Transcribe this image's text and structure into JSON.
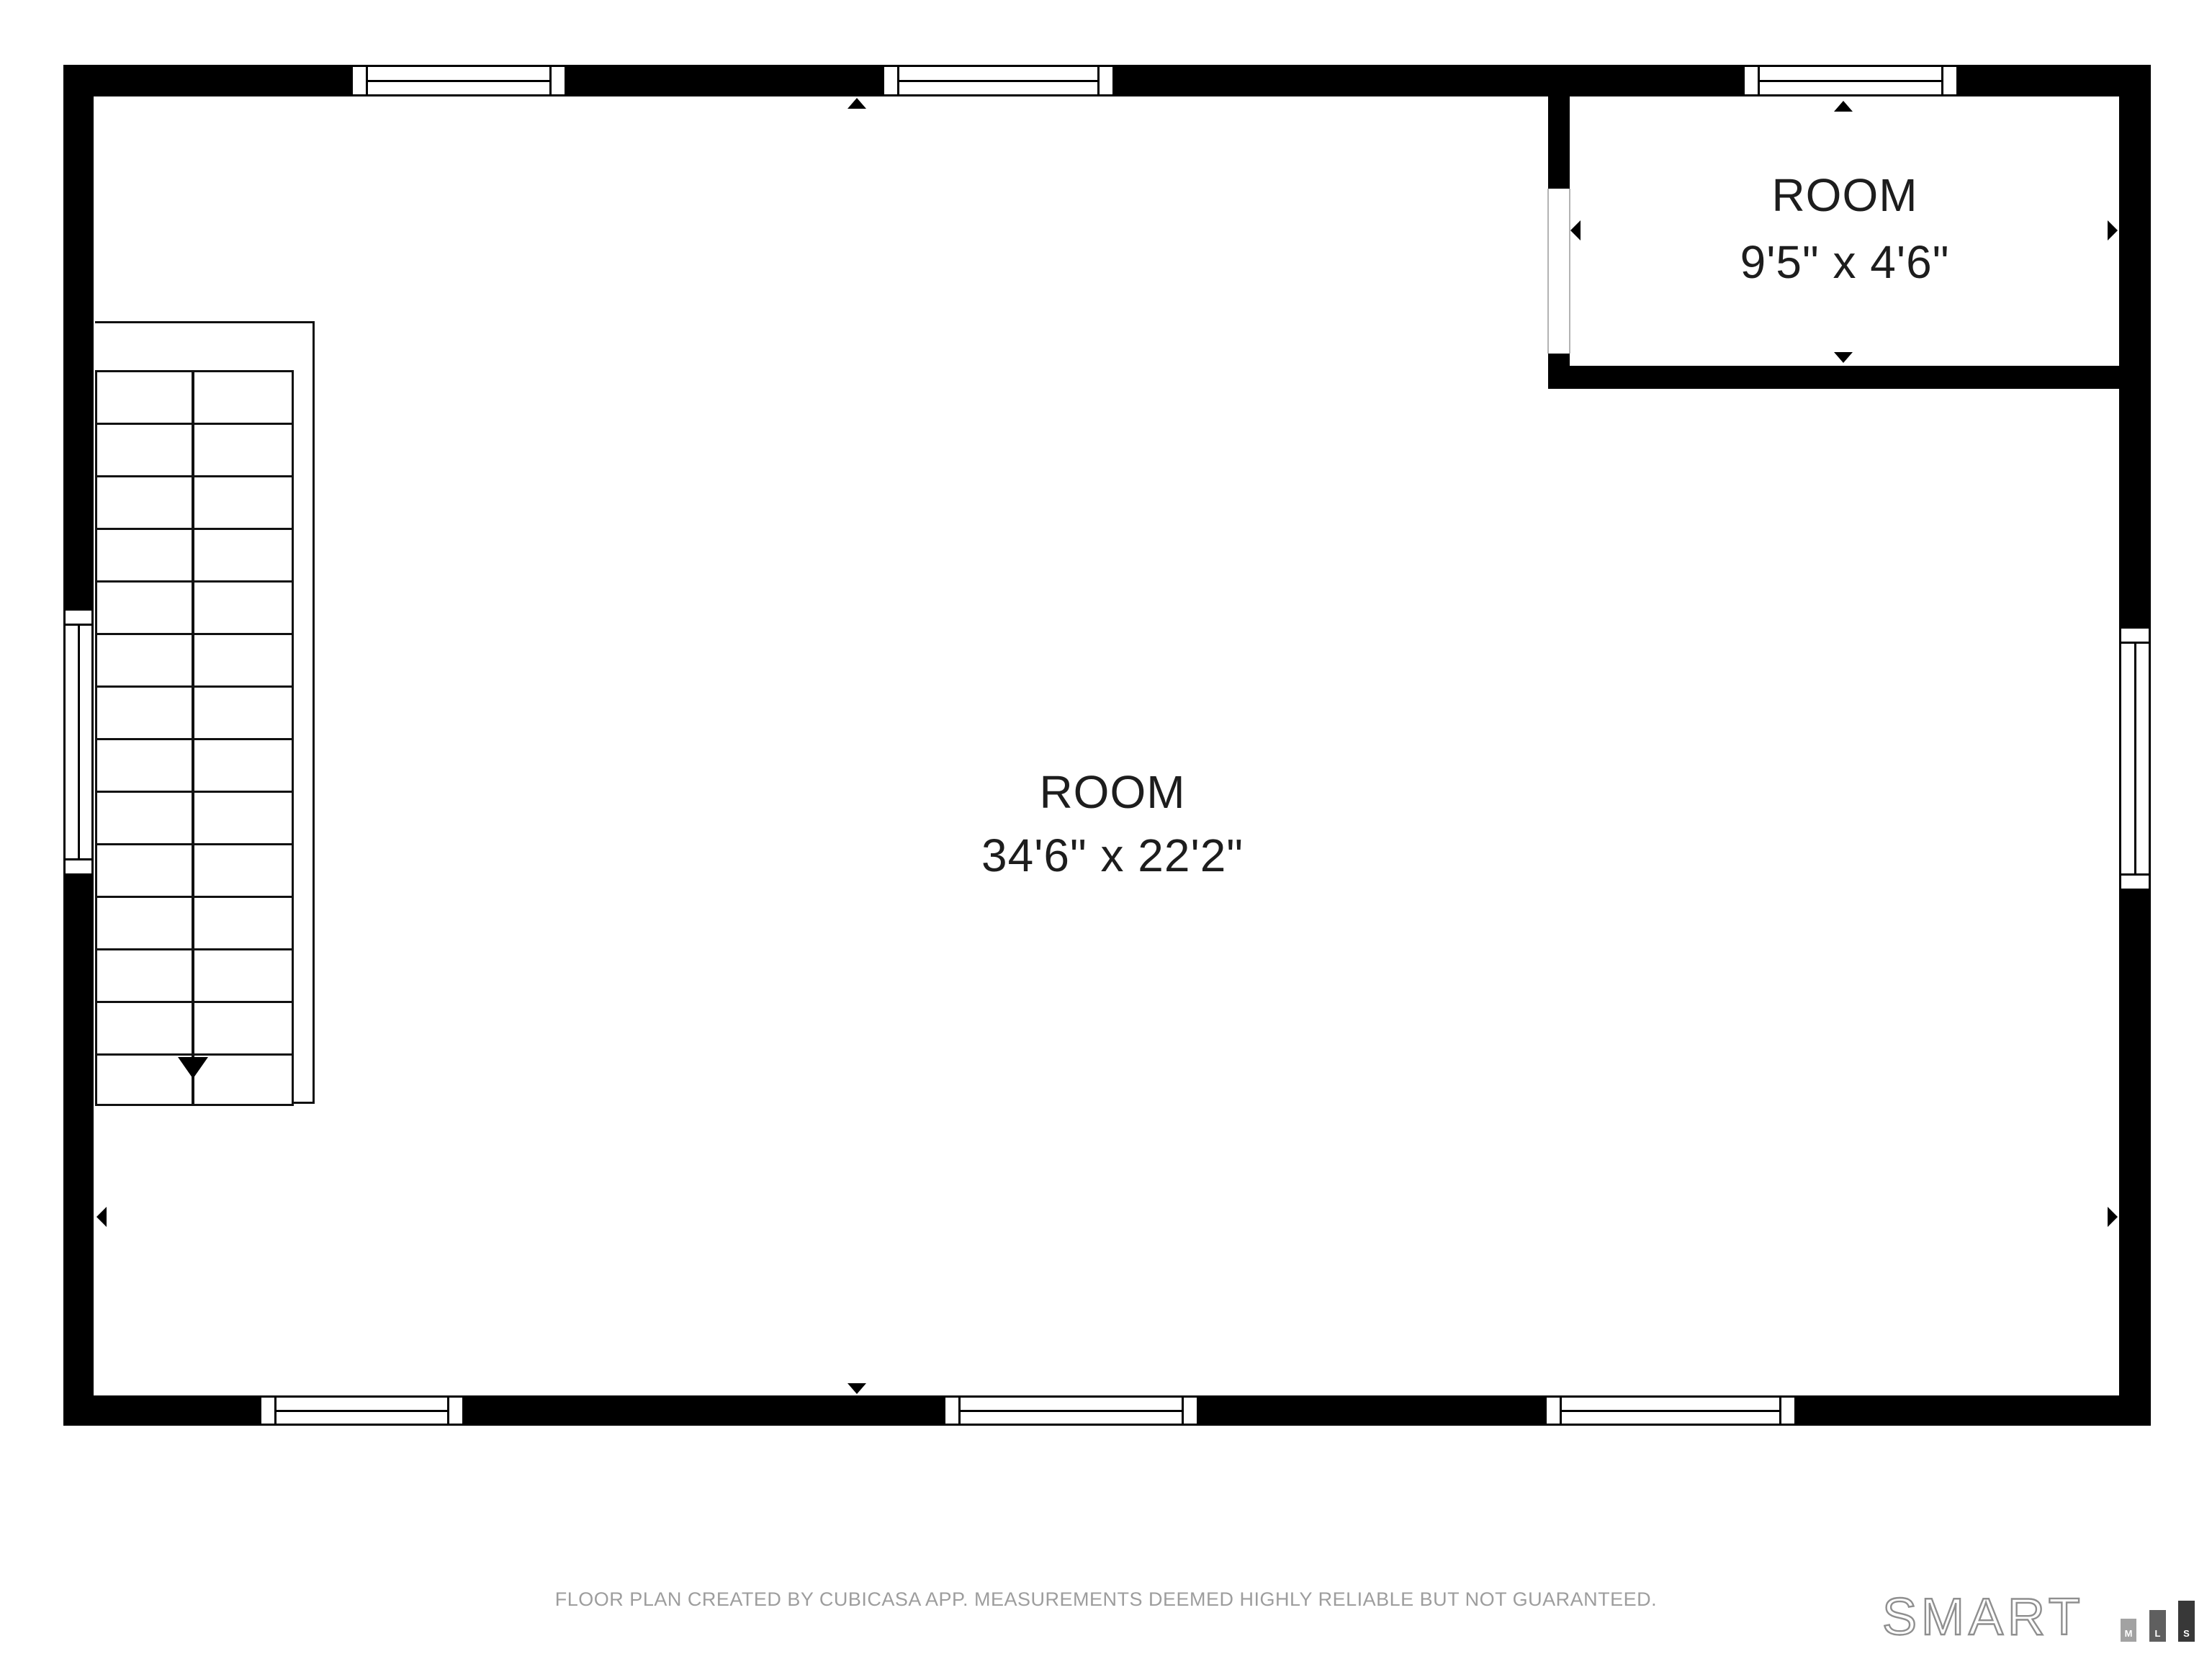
{
  "plan": {
    "rooms": [
      {
        "label": "ROOM",
        "dimensions": "34'6\" x 22'2\""
      },
      {
        "label": "ROOM",
        "dimensions": "9'5\" x 4'6\""
      }
    ]
  },
  "footer": {
    "disclaimer": "FLOOR PLAN CREATED BY CUBICASA APP. MEASUREMENTS DEEMED HIGHLY RELIABLE BUT NOT GUARANTEED."
  },
  "branding": {
    "wordmark": "SMART",
    "bars": [
      {
        "label": "M",
        "color": "#a2a2a2"
      },
      {
        "label": "L",
        "color": "#5f5f5f"
      },
      {
        "label": "S",
        "color": "#383838"
      }
    ]
  },
  "colors": {
    "wall": "#000000",
    "room_label": "#1d1d1d",
    "footer_text": "#9d9d9d",
    "logo_outline": "#8f8f8f"
  }
}
